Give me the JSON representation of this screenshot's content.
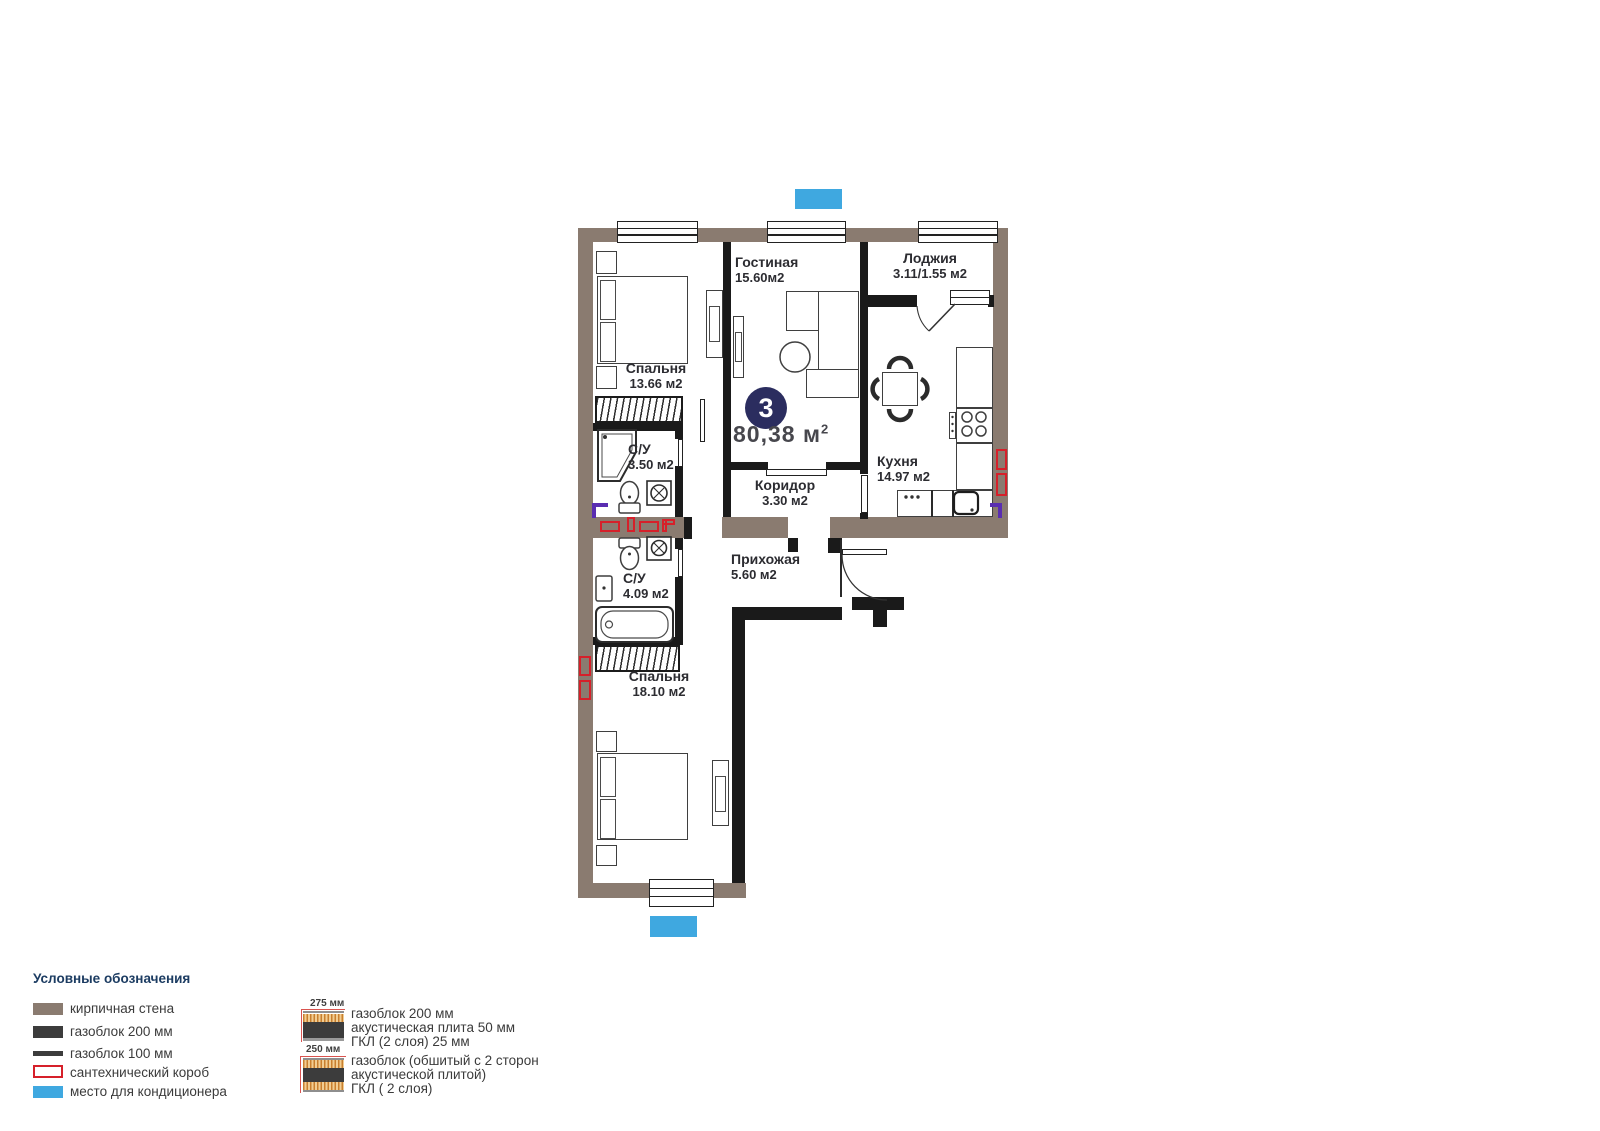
{
  "plan": {
    "badge": {
      "number": "3",
      "area_value": "80,38 м",
      "area_sup": "2"
    },
    "rooms": {
      "living": {
        "name": "Гостиная",
        "area": "15.60м2"
      },
      "loggia": {
        "name": "Лоджия",
        "area": "3.11/1.55 м2"
      },
      "bedroom1": {
        "name": "Спальня",
        "area": "13.66 м2"
      },
      "bath1": {
        "name": "С/У",
        "area": "3.50 м2"
      },
      "kitchen": {
        "name": "Кухня",
        "area": "14.97 м2"
      },
      "corridor": {
        "name": "Коридор",
        "area": "3.30 м2"
      },
      "hall": {
        "name": "Прихожая",
        "area": "5.60 м2"
      },
      "bath2": {
        "name": "С/У",
        "area": "4.09 м2"
      },
      "bedroom2": {
        "name": "Спальня",
        "area": "18.10 м2"
      }
    }
  },
  "legend": {
    "title": "Условные обозначения",
    "items": [
      {
        "label": "кирпичная стена",
        "swatch": "brick"
      },
      {
        "label": "газоблок 200 мм",
        "swatch": "block200"
      },
      {
        "label": "газоблок 100 мм",
        "swatch": "block100"
      },
      {
        "label": "сантехнический короб",
        "swatch": "sanitary-box"
      },
      {
        "label": "место для кондиционера",
        "swatch": "ac-spot"
      }
    ],
    "wall_types": [
      {
        "dimension": "275 мм",
        "lines": [
          "газоблок 200 мм",
          "акустическая плита 50 мм",
          "ГКЛ (2 слоя) 25 мм"
        ]
      },
      {
        "dimension": "250 мм",
        "lines": [
          "газоблок (обшитый с 2 сторон",
          "акустической плитой)",
          "ГКЛ ( 2 слоя)"
        ]
      }
    ]
  },
  "colors": {
    "brick_wall": "#8a7b70",
    "block_wall": "#1a1a1a",
    "sanitary_red": "#d6202a",
    "ac_blue": "#3fa8e0",
    "badge_navy": "#2b2d5f",
    "corner_purple": "#5a2db1"
  }
}
